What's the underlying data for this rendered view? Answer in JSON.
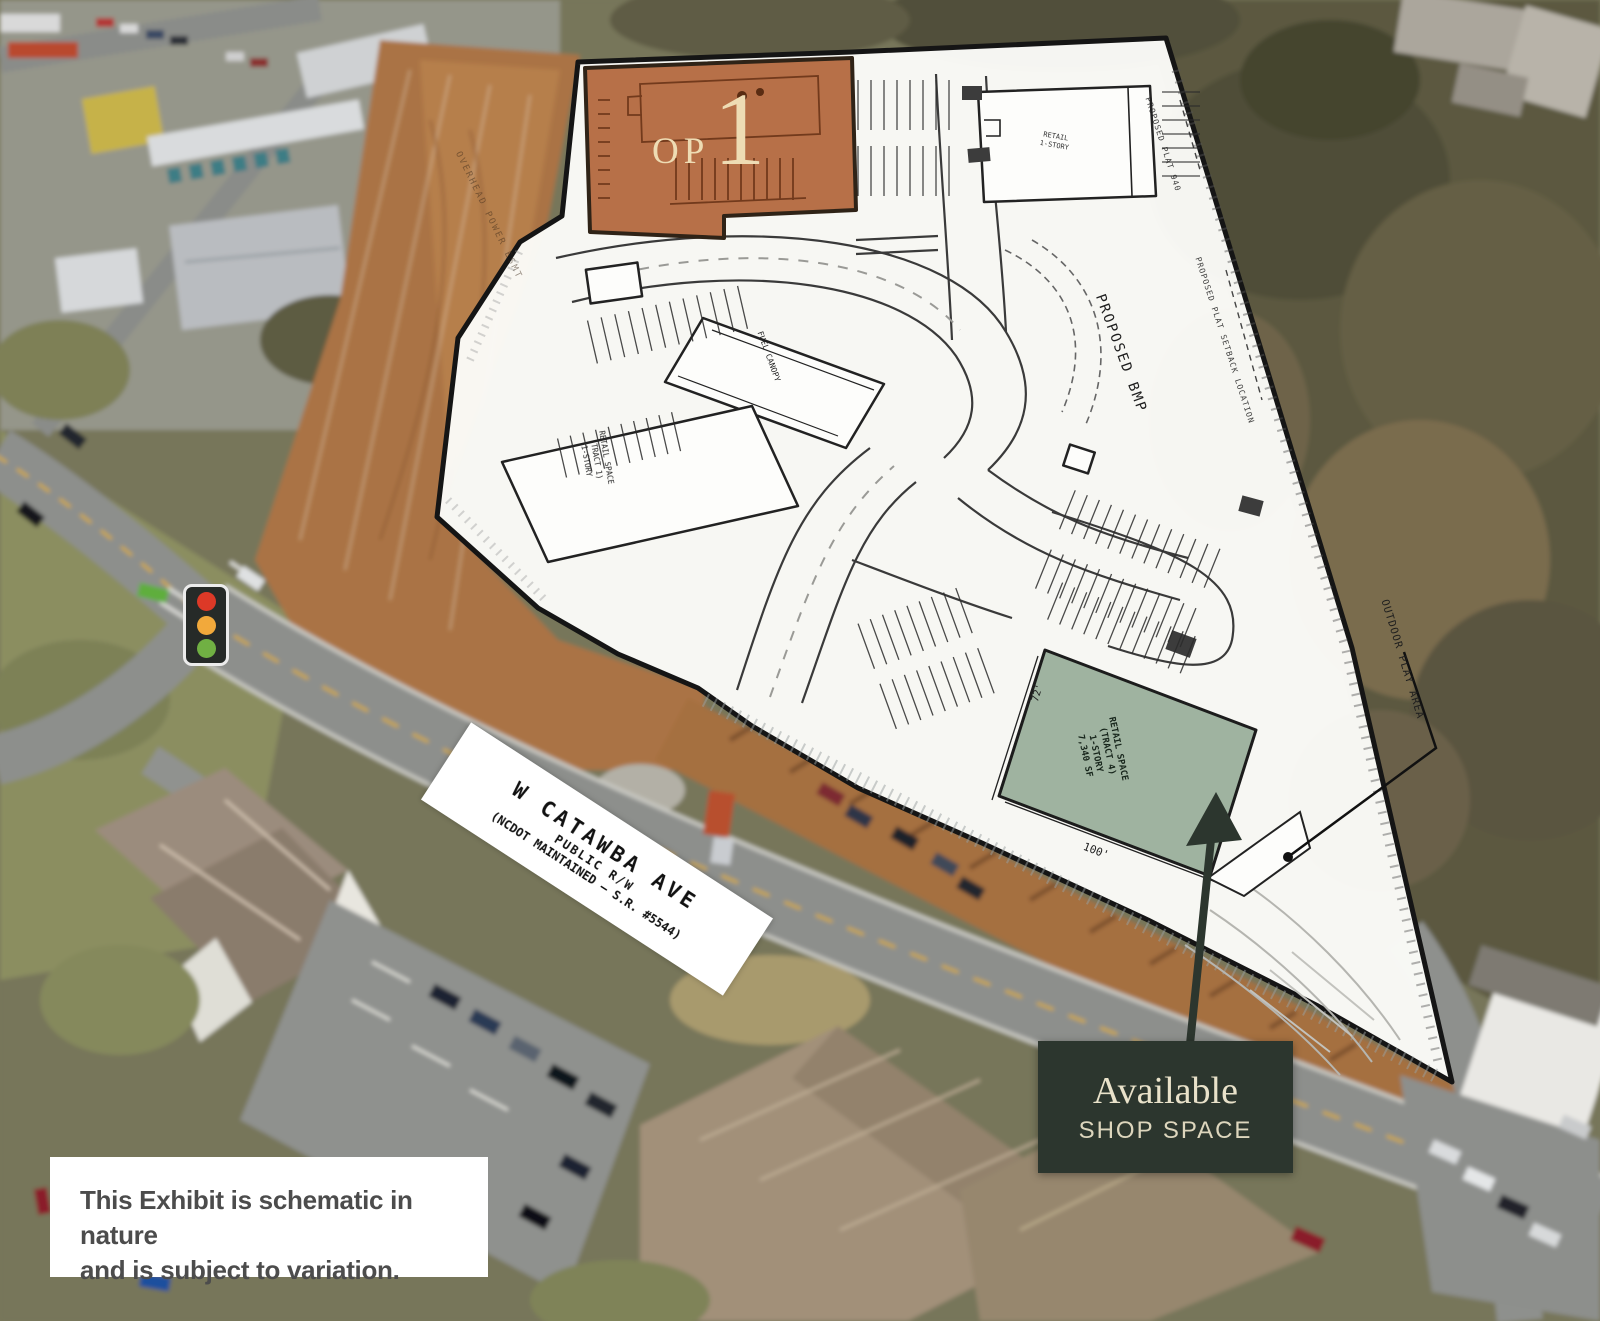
{
  "exhibit": {
    "outparcel": {
      "prefix": "OP",
      "number": "1"
    },
    "street": {
      "name": "W CATAWBA AVE",
      "row": "PUBLIC R/W",
      "maintenance": "(NCDOT MAINTAINED – S.R. #5544)"
    },
    "badge": {
      "title": "Available",
      "subtitle": "SHOP SPACE"
    },
    "disclaimer": {
      "line1": "This Exhibit is schematic in nature",
      "line2": "and is subject to variation."
    },
    "plan_labels": {
      "bmp": "PROPOSED BMP",
      "outdoor_area": "OUTDOOR PLAY AREA",
      "retail_space": {
        "line1": "RETAIL SPACE",
        "line2": "(TRACT 4)",
        "line3": "1-STORY",
        "line4": "7,340 SF"
      },
      "dim_width": "100'",
      "dim_depth": "72'",
      "fuel_canopy": "FUEL CANOPY",
      "left_building": {
        "line1": "RETAIL SPACE",
        "line2": "(TRACT 1)",
        "line3": "1-STORY"
      },
      "top_building": {
        "line1": "RETAIL",
        "line2": "1-STORY"
      },
      "plat_note_upper": "PROPOSED PLAT 940",
      "plat_note_lower": "PROPOSED PLAT SETBACK LOCATION",
      "power_note": "OVERHEAD POWER ESMT"
    },
    "colors": {
      "outparcel_orange": "#b2653a",
      "shop_space_green": "#9fb3a0",
      "badge_bg": "#2c362e",
      "badge_text": "#e9e2ca",
      "plan_ink": "#2b2b2b",
      "traffic_red": "#dd3927",
      "traffic_amber": "#f2a93b",
      "traffic_green": "#70b043"
    }
  }
}
